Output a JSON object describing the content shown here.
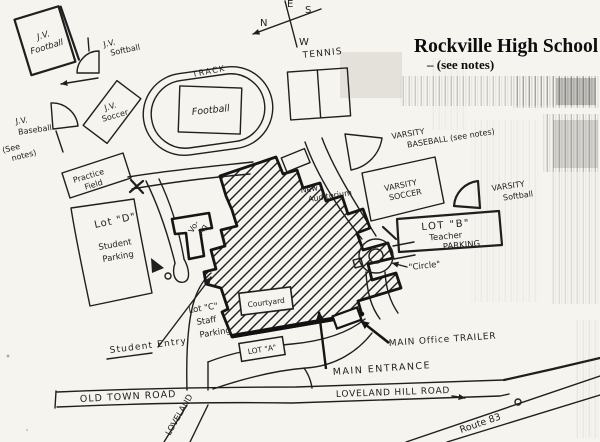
{
  "page": {
    "paper_color": "#f6f4ee",
    "ink_color": "#1f1f1f"
  },
  "title": {
    "main": "Rockville High School",
    "note": "– (see notes)"
  },
  "compass": {
    "n": "N",
    "s": "S",
    "e": "E",
    "w": "W"
  },
  "fields": {
    "jv_football": [
      "J.V.",
      "Football"
    ],
    "jv_softball": [
      "J.V.",
      "Softball"
    ],
    "jv_soccer": [
      "J.V.",
      "Soccer"
    ],
    "jv_baseball": [
      "J.V.",
      "Baseball"
    ],
    "jv_baseball_note": [
      "(See",
      "notes)"
    ],
    "track": "TRACK",
    "football": "Football",
    "tennis": "TENNIS",
    "practice": [
      "Practice",
      "Field"
    ],
    "varsity_baseball": [
      "VARSITY",
      "BASEBALL (see notes)"
    ],
    "varsity_soccer": [
      "VARSITY",
      "SOCCER"
    ],
    "varsity_softball": [
      "VARSITY",
      "Softball"
    ]
  },
  "buildings": {
    "vo_ag": [
      "Vo-",
      "Ag"
    ],
    "new_auditorium": [
      "New",
      "Auditorium"
    ],
    "courtyard": "Courtyard",
    "trailer_label": "MAIN Office TRAILER"
  },
  "lots": {
    "d": [
      "Lot \"D\"",
      "Student",
      "Parking"
    ],
    "b": [
      "LOT \"B\"",
      "Teacher",
      "PARKING"
    ],
    "c": [
      "Lot \"C\"",
      "Staff",
      "Parking"
    ],
    "a": "LOT \"A\""
  },
  "annotations": {
    "student_entry": "Student Entry",
    "main_entrance": "MAIN ENTRANCE",
    "circle": "\"Circle\""
  },
  "roads": {
    "old_town": "OLD TOWN ROAD",
    "loveland_hill": "LOVELAND HILL ROAD",
    "loveland": "LOVELAND",
    "route_83": "Route 83"
  }
}
